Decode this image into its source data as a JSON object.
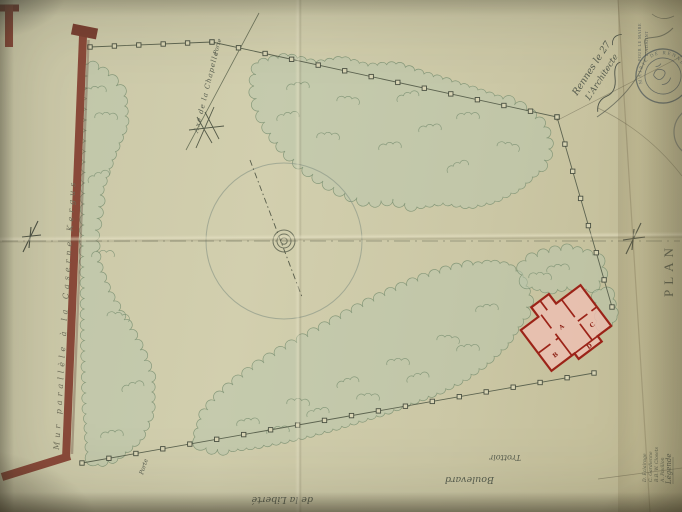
{
  "labels": {
    "axis_chapel": "Axe de la Chapelle",
    "gate_top": "Porte",
    "gate_bottom": "Porte",
    "party_wall": "Mur parallèle à la Caserne Kergus",
    "sidewalk": "Trottoir",
    "boulevard_line1": "Boulevard",
    "boulevard_line2": "de la Liberté",
    "plan_title": "PLAN"
  },
  "annotation": {
    "date_line": "Rennes le 27",
    "architect_line": "L'Architecte"
  },
  "stamps": {
    "mairie_round": "MAIRIE DE RENNES",
    "pour_le_maire": "POUR LE MAIRE",
    "adjoint": "L'ADJOINT"
  },
  "legend": {
    "heading": "Légende",
    "items": [
      "A. Pavillon",
      "B.B. W. Closets",
      "C. Gardienne",
      "D. Éclairage"
    ]
  },
  "building": {
    "room_a": "A",
    "room_b": "B",
    "room_c": "C",
    "room_d": "D"
  },
  "colors": {
    "paper": "#cecaa9",
    "tree_wash": "#b7c6ab",
    "wall_masonry": "#8a4a3a",
    "building_fill": "#ecc0b2",
    "building_wall": "#9c2318",
    "ink": "#565c4e",
    "stamp": "#41505b"
  }
}
